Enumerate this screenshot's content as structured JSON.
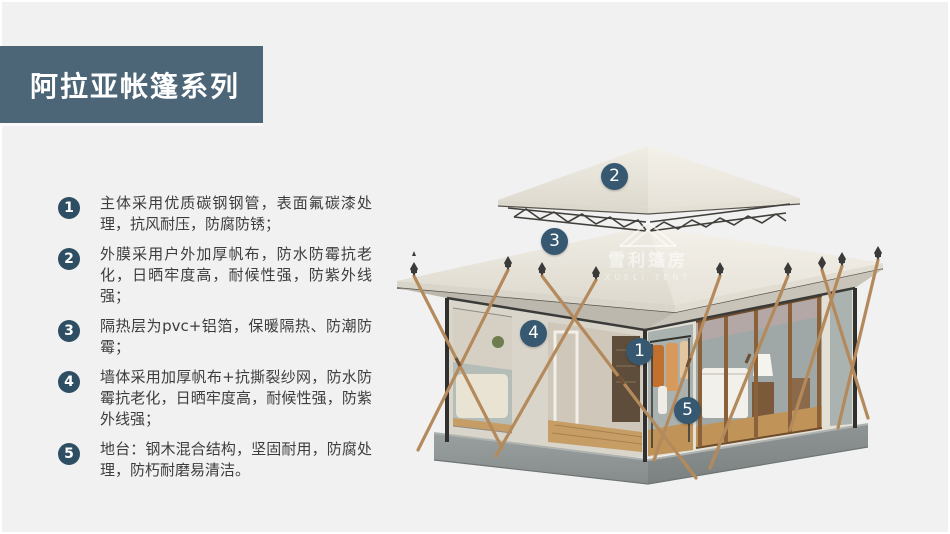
{
  "header": {
    "title": "阿拉亚帐篷系列"
  },
  "features": {
    "items": [
      {
        "num": "1",
        "text": "主体采用优质碳钢钢管，表面氟碳漆处理，抗风耐压，防腐防锈；"
      },
      {
        "num": "2",
        "text": "外膜采用户外加厚帆布，防水防霉抗老化，日晒牢度高，耐候性强，防紫外线强；"
      },
      {
        "num": "3",
        "text": "隔热层为pvc+铝箔，保暖隔热、防潮防霉；"
      },
      {
        "num": "4",
        "text": "墙体采用加厚帆布+抗撕裂纱网，防水防霉抗老化，日晒牢度高，耐候性强，防紫外线强；"
      },
      {
        "num": "5",
        "text": "地台：钢木混合结构，坚固耐用，防腐处理，防朽耐磨易清洁。"
      }
    ]
  },
  "tent": {
    "markers": [
      {
        "num": "1"
      },
      {
        "num": "2"
      },
      {
        "num": "3"
      },
      {
        "num": "4"
      },
      {
        "num": "5"
      }
    ],
    "watermark": {
      "cn": "雪利篷房",
      "en": "XUELI TENT"
    }
  },
  "colors": {
    "banner_bg": "#4c6577",
    "list_badge_bg": "#2e4e63",
    "marker_bg": "#365871",
    "page_bg": "#f1f1f2",
    "body_text": "#3d3d3d",
    "roof_cream": "#eceae1",
    "plinth_gray": "#8f9594",
    "pole_tan": "#b48a5c"
  }
}
